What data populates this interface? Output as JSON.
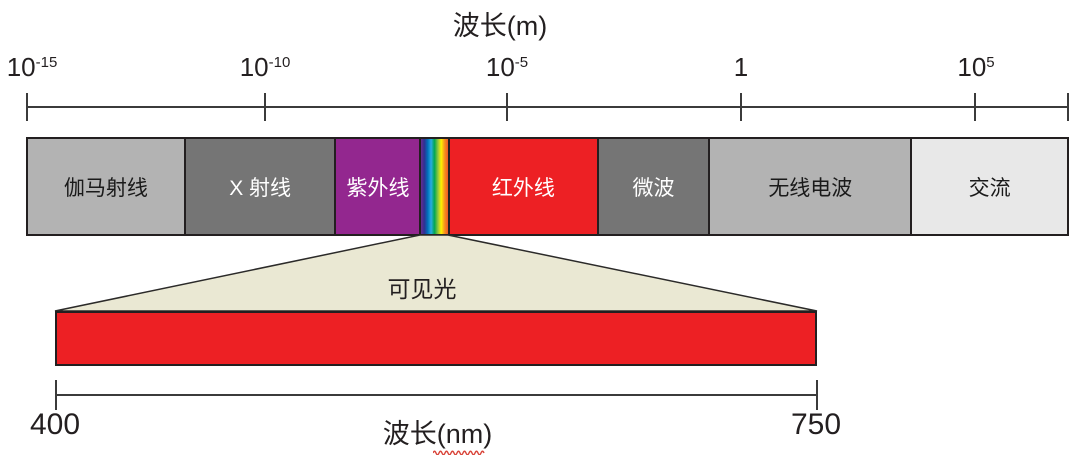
{
  "title": "波长(m)",
  "top_axis": {
    "unit": "m",
    "ticks": [
      {
        "base": "10",
        "exp": "-15"
      },
      {
        "base": "10",
        "exp": "-10"
      },
      {
        "base": "10",
        "exp": "-5"
      },
      {
        "base": "1",
        "exp": ""
      },
      {
        "base": "10",
        "exp": "5"
      },
      {
        "base": "",
        "exp": ""
      }
    ]
  },
  "spectrum_bar": {
    "segments": [
      {
        "label": "伽马射线",
        "color": "#b3b3b3",
        "text_color": "#1a1a1a",
        "width_pct": 15.2
      },
      {
        "label": "X 射线",
        "color": "#757575",
        "text_color": "#ffffff",
        "width_pct": 14.5
      },
      {
        "label": "紫外线",
        "color": "#93278f",
        "text_color": "#ffffff",
        "width_pct": 8.1
      },
      {
        "label": "",
        "gradient": [
          "#662d91",
          "#2e3192",
          "#0071bc",
          "#29abe2",
          "#00a651",
          "#8dc63f",
          "#fff200",
          "#f7931e",
          "#f15a24"
        ],
        "width_pct": 2.6
      },
      {
        "label": "红外线",
        "color": "#ed2024",
        "text_color": "#ffffff",
        "width_pct": 14.3
      },
      {
        "label": "微波",
        "color": "#757575",
        "text_color": "#ffffff",
        "width_pct": 10.7
      },
      {
        "label": "无线电波",
        "color": "#b3b3b3",
        "text_color": "#1a1a1a",
        "width_pct": 19.5
      },
      {
        "label": "交流",
        "color": "#e8e8e8",
        "text_color": "#1a1a1a",
        "width_pct": 15.1
      }
    ]
  },
  "visible_light": {
    "label": "可见光",
    "funnel_color": "#eae8d3",
    "bar_color": "#ed2024",
    "scale_min": "400",
    "scale_max": "750",
    "axis_label": "波长(nm)"
  },
  "colors": {
    "line": "#3b3b3b",
    "border": "#231f20",
    "squiggle": "#d9453a"
  }
}
